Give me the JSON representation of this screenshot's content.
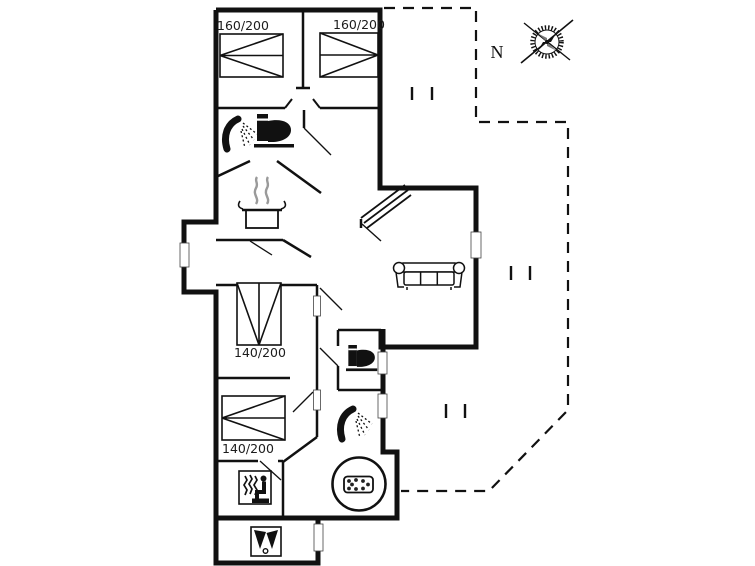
{
  "plan": {
    "type": "holiday-house-floor-plan",
    "colors": {
      "wall": "#111111",
      "background": "#ffffff",
      "steam": "#9a9a9a"
    },
    "compass": {
      "north_label": "N"
    },
    "bedrooms": [
      {
        "id": "bedroom-1",
        "bed_label": "160/200"
      },
      {
        "id": "bedroom-2",
        "bed_label": "160/200"
      },
      {
        "id": "bedroom-3",
        "bed_label": "140/200"
      },
      {
        "id": "bedroom-4",
        "bed_label": "140/200"
      }
    ],
    "fixtures": [
      {
        "room": "bathroom-1",
        "icons": [
          "shower-icon",
          "toilet-icon"
        ]
      },
      {
        "room": "kitchen",
        "icons": [
          "cooking-pot-icon"
        ]
      },
      {
        "room": "living-room",
        "icons": [
          "sofa-icon"
        ]
      },
      {
        "room": "wc",
        "icons": [
          "toilet-icon"
        ]
      },
      {
        "room": "bathroom-2",
        "icons": [
          "shower-icon",
          "whirlpool-icon"
        ]
      },
      {
        "room": "sauna-room",
        "icons": [
          "sauna-icon"
        ]
      },
      {
        "room": "activity-room",
        "icons": [
          "table-tennis-icon"
        ]
      },
      {
        "outdoor": "terrace",
        "style": "dashed-outline"
      }
    ]
  }
}
